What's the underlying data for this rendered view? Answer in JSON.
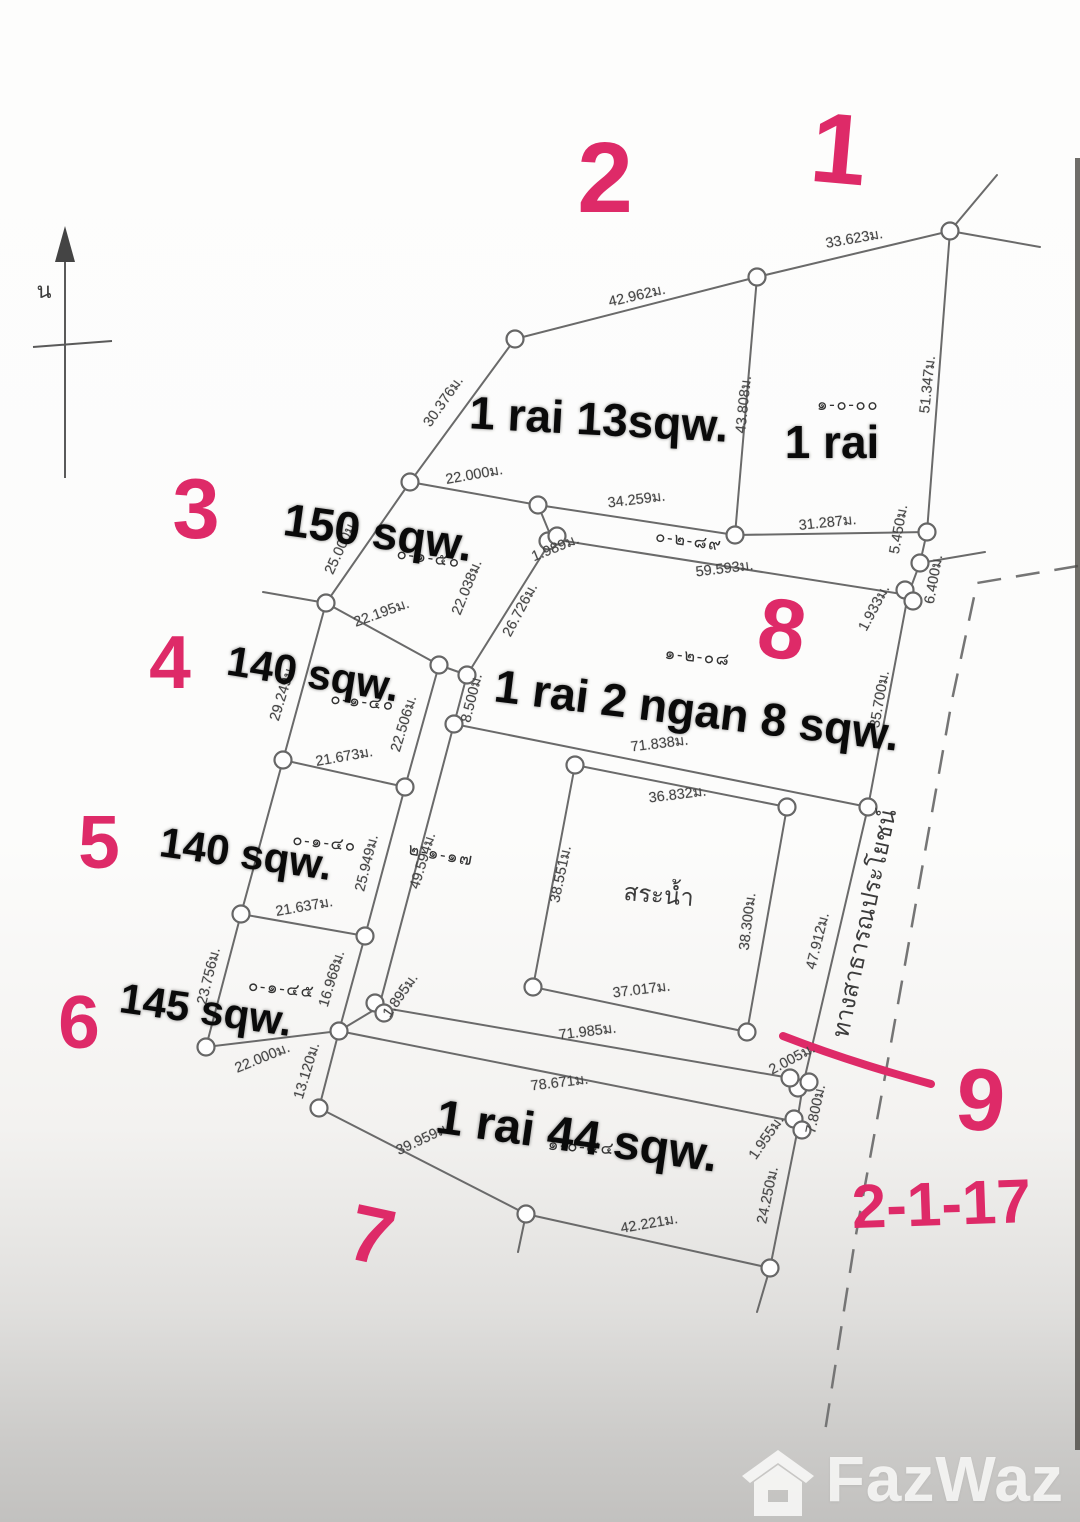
{
  "colors": {
    "annotation_pink": "#de2a68",
    "line_gray": "#6a6a6a"
  },
  "watermark": {
    "brand": "FazWaz"
  },
  "labels": {
    "measurements": [
      {
        "t": "33.623ม.",
        "x": 855,
        "y": 243,
        "r": -10
      },
      {
        "t": "42.962ม.",
        "x": 638,
        "y": 300,
        "r": -13
      },
      {
        "t": "30.376ม.",
        "x": 447,
        "y": 404,
        "r": -55
      },
      {
        "t": "51.347ม.",
        "x": 932,
        "y": 385,
        "r": -84
      },
      {
        "t": "43.808ม.",
        "x": 748,
        "y": 405,
        "r": -84
      },
      {
        "t": "31.287ม.",
        "x": 828,
        "y": 527,
        "r": -6
      },
      {
        "t": "5.450ม.",
        "x": 903,
        "y": 530,
        "r": -80
      },
      {
        "t": "6.400ม.",
        "x": 938,
        "y": 580,
        "r": -80
      },
      {
        "t": "1.933ม.",
        "x": 878,
        "y": 610,
        "r": -62
      },
      {
        "t": "22.000ม.",
        "x": 475,
        "y": 479,
        "r": -10
      },
      {
        "t": "34.259ม.",
        "x": 637,
        "y": 504,
        "r": -7
      },
      {
        "t": "59.593ม.",
        "x": 725,
        "y": 573,
        "r": -7
      },
      {
        "t": "1.989ม.",
        "x": 557,
        "y": 552,
        "r": -22
      },
      {
        "t": "26.726ม.",
        "x": 524,
        "y": 612,
        "r": -62
      },
      {
        "t": "35.700ม.",
        "x": 884,
        "y": 700,
        "r": -80
      },
      {
        "t": "71.838ม.",
        "x": 660,
        "y": 748,
        "r": -7
      },
      {
        "t": "36.832ม.",
        "x": 678,
        "y": 799,
        "r": -7
      },
      {
        "t": "38.551ม.",
        "x": 565,
        "y": 875,
        "r": -78
      },
      {
        "t": "38.300ม.",
        "x": 752,
        "y": 922,
        "r": -83
      },
      {
        "t": "37.017ม.",
        "x": 642,
        "y": 994,
        "r": -7
      },
      {
        "t": "49.594ม.",
        "x": 427,
        "y": 862,
        "r": -73
      },
      {
        "t": "1.895ม.",
        "x": 404,
        "y": 998,
        "r": -55
      },
      {
        "t": "71.985ม.",
        "x": 588,
        "y": 1036,
        "r": -7
      },
      {
        "t": "47.912ม.",
        "x": 822,
        "y": 942,
        "r": -76
      },
      {
        "t": "2.005ม.",
        "x": 794,
        "y": 1063,
        "r": -28
      },
      {
        "t": "7.800ม.",
        "x": 820,
        "y": 1110,
        "r": -78
      },
      {
        "t": "1.955ม.",
        "x": 770,
        "y": 1140,
        "r": -55
      },
      {
        "t": "24.250ม.",
        "x": 772,
        "y": 1196,
        "r": -78
      },
      {
        "t": "42.221ม.",
        "x": 650,
        "y": 1228,
        "r": -10
      },
      {
        "t": "78.671ม.",
        "x": 560,
        "y": 1087,
        "r": -7
      },
      {
        "t": "39.959ม.",
        "x": 425,
        "y": 1143,
        "r": -25
      },
      {
        "t": "13.120ม.",
        "x": 311,
        "y": 1072,
        "r": -73
      },
      {
        "t": "22.000ม.",
        "x": 264,
        "y": 1062,
        "r": -22
      },
      {
        "t": "23.756ม.",
        "x": 213,
        "y": 977,
        "r": -76
      },
      {
        "t": "16.968ม.",
        "x": 336,
        "y": 980,
        "r": -73
      },
      {
        "t": "25.949ม.",
        "x": 371,
        "y": 864,
        "r": -76
      },
      {
        "t": "21.637ม.",
        "x": 305,
        "y": 911,
        "r": -10
      },
      {
        "t": "21.673ม.",
        "x": 345,
        "y": 761,
        "r": -10
      },
      {
        "t": "22.506ม.",
        "x": 408,
        "y": 725,
        "r": -73
      },
      {
        "t": "29.249ม.",
        "x": 287,
        "y": 694,
        "r": -73
      },
      {
        "t": "8.500ม.",
        "x": 476,
        "y": 699,
        "r": -76
      },
      {
        "t": "22.195ม.",
        "x": 383,
        "y": 617,
        "r": -20
      },
      {
        "t": "22.038ม.",
        "x": 471,
        "y": 589,
        "r": -68
      },
      {
        "t": "25.000ม.",
        "x": 345,
        "y": 549,
        "r": -65
      }
    ],
    "areas": [
      {
        "t": "1 rai 13sqw.",
        "x": 598,
        "y": 435,
        "r": 3,
        "s": 46
      },
      {
        "t": "1 rai",
        "x": 832,
        "y": 458,
        "r": 0,
        "s": 46
      },
      {
        "t": "150 sqw.",
        "x": 376,
        "y": 548,
        "r": 8,
        "s": 46
      },
      {
        "t": "140 sqw.",
        "x": 311,
        "y": 688,
        "r": 9,
        "s": 42
      },
      {
        "t": "140 sqw.",
        "x": 244,
        "y": 868,
        "r": 8,
        "s": 42
      },
      {
        "t": "145 sqw.",
        "x": 204,
        "y": 1024,
        "r": 8,
        "s": 42
      },
      {
        "t": "1 rai 2 ngan 8 sqw.",
        "x": 695,
        "y": 726,
        "r": 7,
        "s": 46
      },
      {
        "t": "1 rai 44 sqw.",
        "x": 575,
        "y": 1152,
        "r": 8,
        "s": 48
      }
    ],
    "deeds": [
      {
        "t": "๑-๐-๐๐",
        "x": 848,
        "y": 410,
        "r": 0
      },
      {
        "t": "๐-๒-๘๙",
        "x": 688,
        "y": 546,
        "r": 8
      },
      {
        "t": "๐-๑-๕๐",
        "x": 428,
        "y": 563,
        "r": 8
      },
      {
        "t": "๐-๑-๔๐",
        "x": 362,
        "y": 707,
        "r": 6
      },
      {
        "t": "๐-๑-๔๐",
        "x": 324,
        "y": 848,
        "r": 6
      },
      {
        "t": "๐-๑-๔๕",
        "x": 281,
        "y": 994,
        "r": 6
      },
      {
        "t": "๑-๒-๐๘",
        "x": 697,
        "y": 662,
        "r": 6
      },
      {
        "t": "๒-๑-๑๗",
        "x": 440,
        "y": 860,
        "r": 10
      },
      {
        "t": "๑-๐-๔๔",
        "x": 581,
        "y": 1152,
        "r": 4
      }
    ],
    "annotations": [
      {
        "t": "1",
        "x": 836,
        "y": 183,
        "r": 5,
        "s": 100
      },
      {
        "t": "2",
        "x": 605,
        "y": 212,
        "r": 0,
        "s": 100
      },
      {
        "t": "3",
        "x": 196,
        "y": 538,
        "r": 0,
        "s": 85
      },
      {
        "t": "4",
        "x": 170,
        "y": 688,
        "r": 0,
        "s": 75
      },
      {
        "t": "5",
        "x": 99,
        "y": 868,
        "r": 0,
        "s": 75
      },
      {
        "t": "6",
        "x": 79,
        "y": 1048,
        "r": 0,
        "s": 75
      },
      {
        "t": "7",
        "x": 366,
        "y": 1262,
        "r": 12,
        "s": 80
      },
      {
        "t": "8",
        "x": 778,
        "y": 658,
        "r": 8,
        "s": 85
      },
      {
        "t": "9",
        "x": 978,
        "y": 1130,
        "r": 5,
        "s": 88
      },
      {
        "t": "2-1-17",
        "x": 942,
        "y": 1225,
        "r": -2,
        "s": 62
      }
    ],
    "misc": [
      {
        "t": "สระน้ำ",
        "x": 658,
        "y": 903,
        "r": 5,
        "s": 24,
        "n": "pond-label"
      },
      {
        "t": "ทางสาธารณประโยชน์",
        "x": 872,
        "y": 925,
        "r": -78,
        "s": 24,
        "n": "public-road-label"
      },
      {
        "t": "น",
        "x": 44,
        "y": 298,
        "r": 0,
        "s": 22,
        "n": "north-label"
      }
    ]
  }
}
